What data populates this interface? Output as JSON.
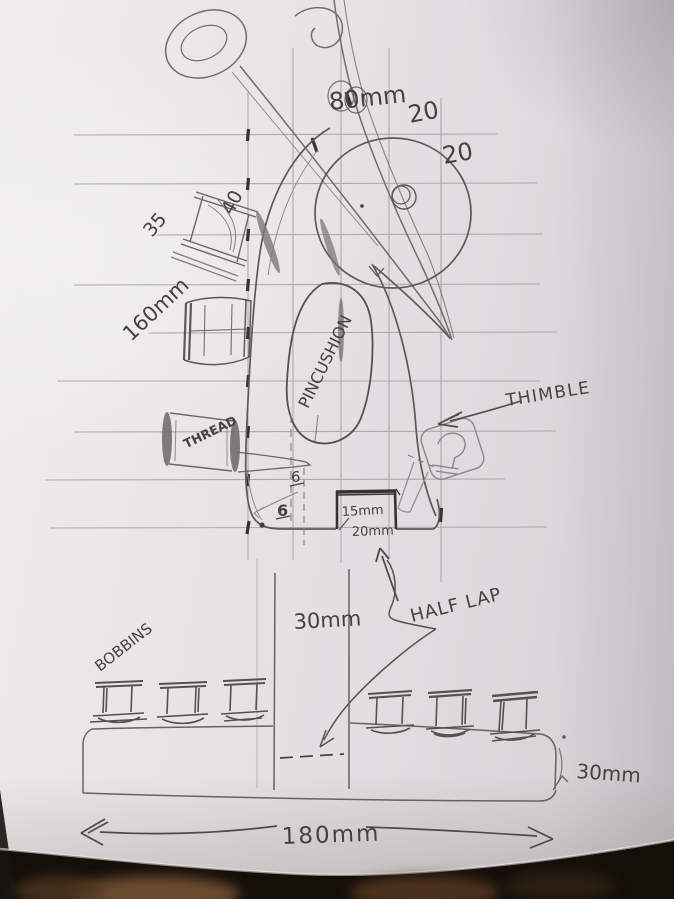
{
  "labels": {
    "blade_dim": "80mm",
    "grid_dim_1": "20",
    "grid_dim_2": "20",
    "spool_dim_a": "35",
    "spool_dim_b": "40",
    "height_dim": "160mm",
    "pincushion": "PINCUSHION",
    "thread": "THREAD",
    "thimble": "THIMBLE",
    "offset_a": "6",
    "offset_b": "6",
    "slot_depth": "15mm",
    "slot_width": "20mm",
    "post_width": "30mm",
    "joint_note": "HALF LAP",
    "bobbins": "BOBBINS",
    "base_thickness": "30mm",
    "base_length": "180mm"
  },
  "colors": {
    "paper": "#e7e4e6",
    "pencil_light": "#a39ea1",
    "pencil_medium": "#6b6765",
    "pencil_dark": "#57534f",
    "pencil_heavy": "#343130",
    "handwriting": "#45413f",
    "desk_dark": "#150f0a",
    "finger_brown": "#7a5636"
  }
}
